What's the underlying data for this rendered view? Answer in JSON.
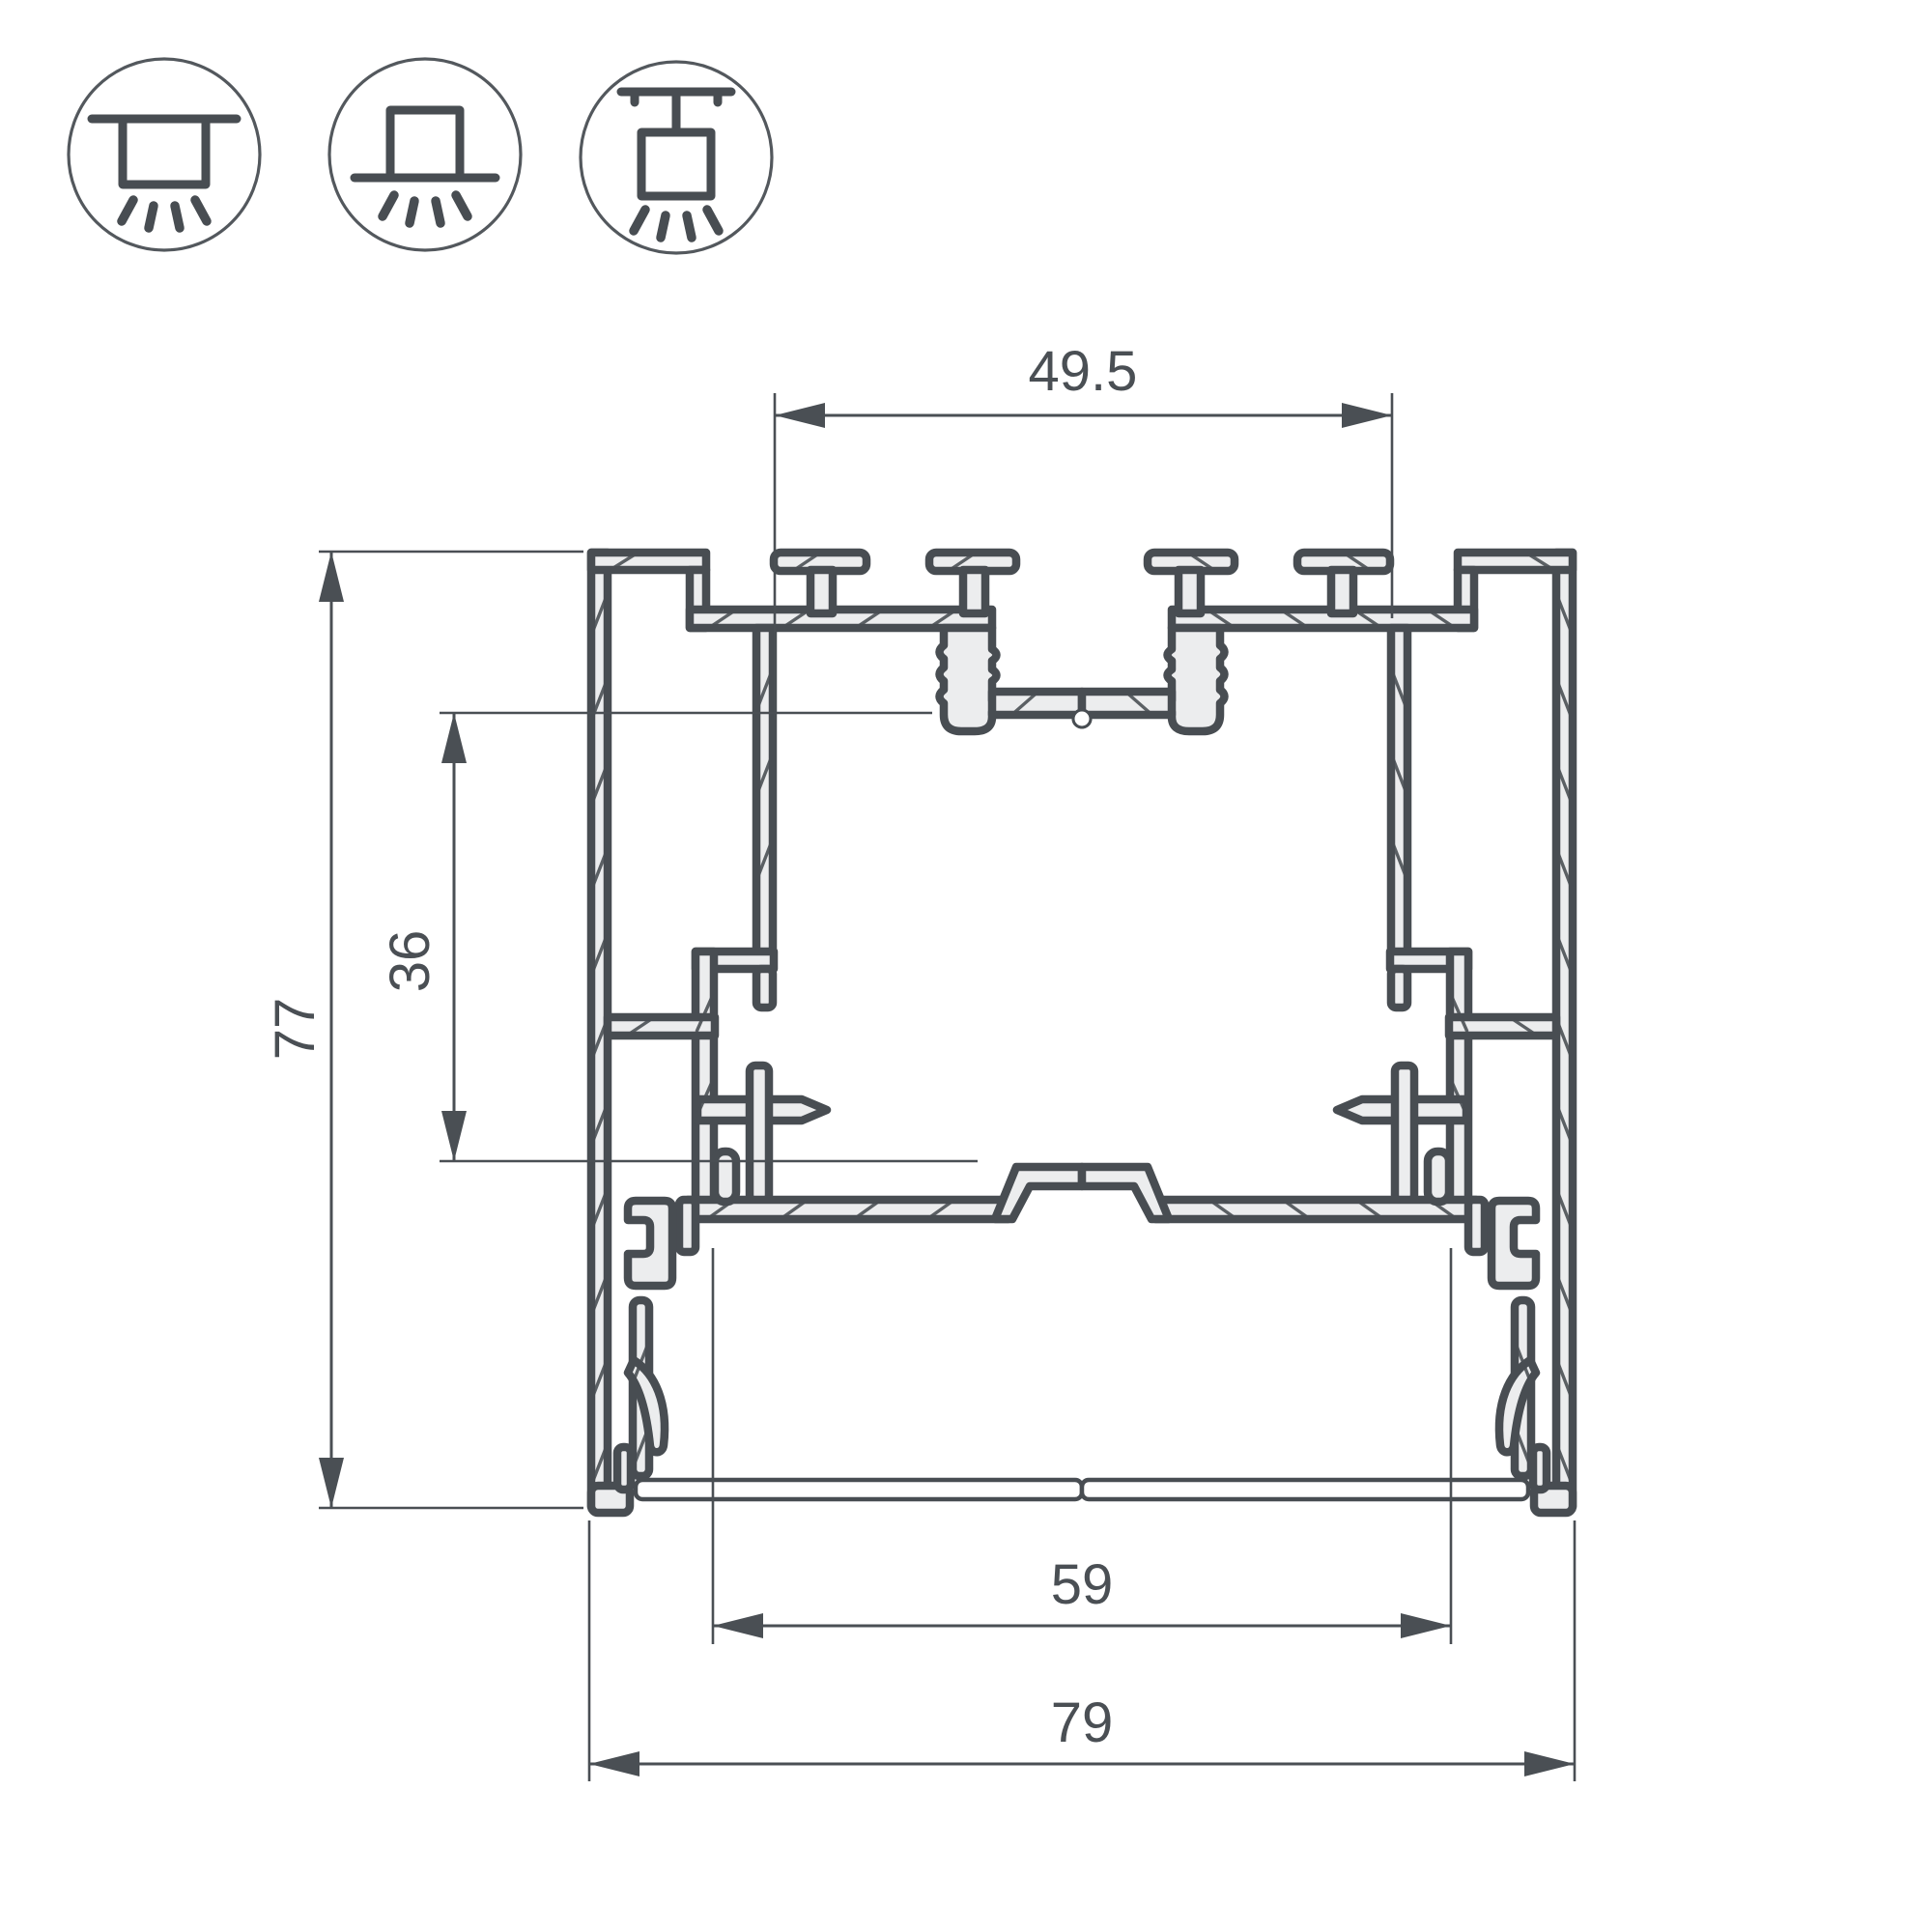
{
  "drawing": {
    "title": "led-profile-cross-section",
    "dimensions": {
      "top_width": {
        "value": "49.5"
      },
      "inner_height": {
        "value": "36"
      },
      "overall_height": {
        "value": "77"
      },
      "inner_width": {
        "value": "59"
      },
      "overall_width": {
        "value": "79"
      }
    },
    "mount_icons": [
      {
        "name": "recessed-mount-icon"
      },
      {
        "name": "surface-mount-icon"
      },
      {
        "name": "suspended-mount-icon"
      }
    ],
    "colors": {
      "line": "#484D52",
      "fill": "#ECEDEE",
      "background": "#FFFFFF"
    }
  }
}
